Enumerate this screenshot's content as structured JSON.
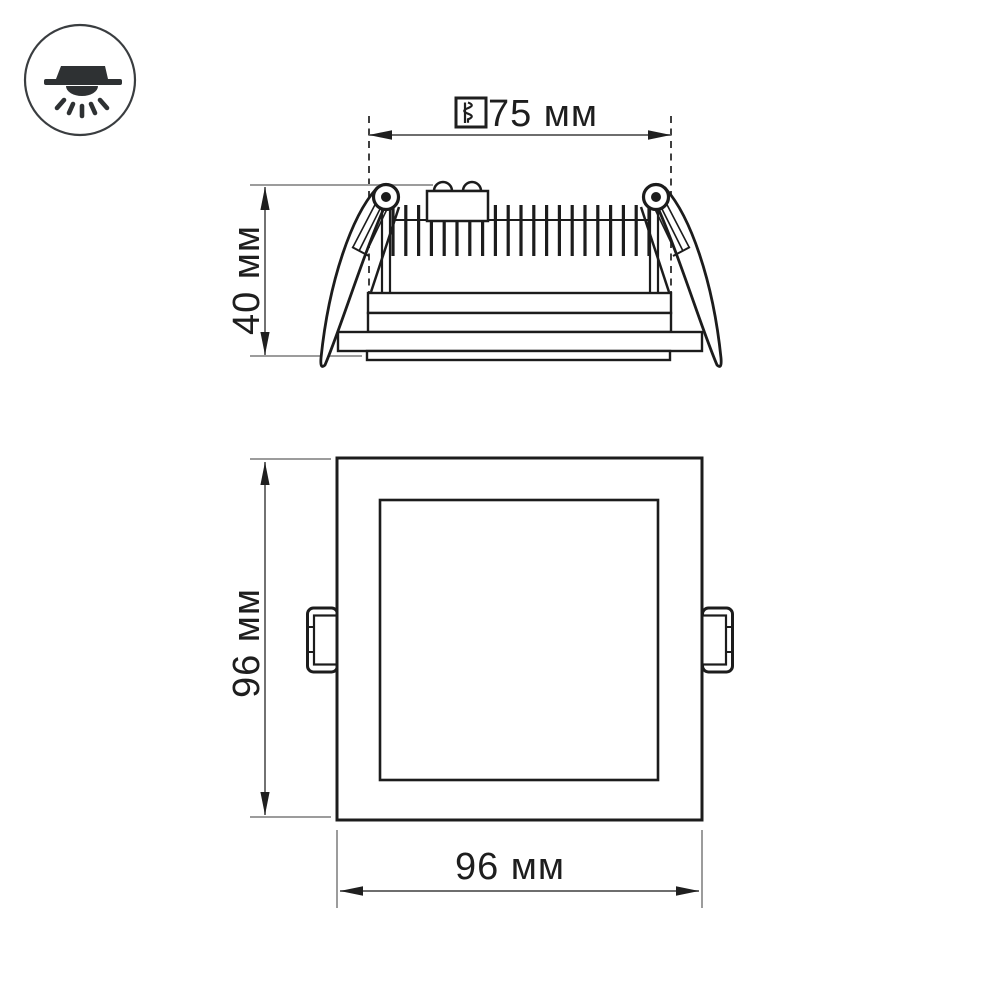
{
  "document": {
    "type": "technical-dimension-drawing",
    "subject": "recessed-square-led-downlight",
    "background": "#ffffff"
  },
  "colors": {
    "main_line": "#1c1c1c",
    "extension_line": "#9c9c9c",
    "dimension_line": "#5a5a5a",
    "arrowhead": "#1f1f1f",
    "label_text": "#1e1e1e",
    "badge_glyph": "#2e3133"
  },
  "icons": {
    "badge": "recessed-downlight-icon",
    "cutout": "cutout-hole-icon"
  },
  "labels": {
    "cutout": "75 мм",
    "depth": "40 мм",
    "front_height": "96 мм",
    "front_width": "96 мм"
  },
  "views": {
    "side_view": "fixture side profile with heatsink fins and spring clips",
    "front_view": "square panel face with side mounting tabs"
  }
}
